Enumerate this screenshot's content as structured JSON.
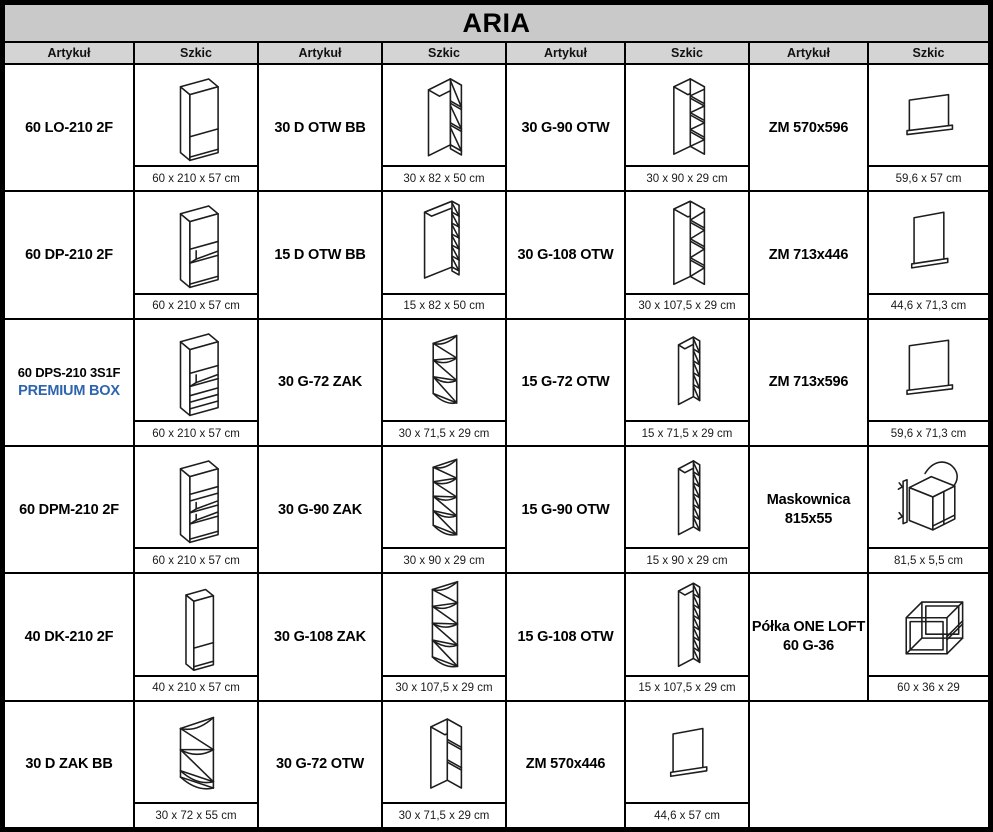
{
  "title": "ARIA",
  "colors": {
    "title_bg": "#c9c9c9",
    "header_bg": "#d4d4d4",
    "border": "#000000",
    "premium_blue": "#2e64ae"
  },
  "column_headers": {
    "article": "Artykuł",
    "sketch": "Szkic"
  },
  "rows": [
    {
      "cells": [
        {
          "article": "60 LO-210 2F",
          "sketch": "tall-2f",
          "dims": "60 x 210 x 57 cm"
        },
        {
          "article": "30 D OTW BB",
          "sketch": "base-open",
          "dims": "30 x 82 x 50 cm"
        },
        {
          "article": "30 G-90 OTW",
          "sketch": "wall-open-4",
          "dims": "30 x 90 x 29 cm"
        },
        {
          "article": "ZM 570x596",
          "sketch": "panel-landscape",
          "dims": "59,6 x 57 cm"
        }
      ]
    },
    {
      "cells": [
        {
          "article": "60 DP-210 2F",
          "sketch": "tall-oven",
          "dims": "60 x 210 x 57 cm"
        },
        {
          "article": "15 D OTW BB",
          "sketch": "base-open-slim",
          "dims": "15 x 82 x 50 cm"
        },
        {
          "article": "30 G-108 OTW",
          "sketch": "wall-open-4-tall",
          "dims": "30 x 107,5 x 29 cm"
        },
        {
          "article": "ZM 713x446",
          "sketch": "panel-portrait",
          "dims": "44,6 x 71,3 cm"
        }
      ]
    },
    {
      "cells": [
        {
          "article": "60 DPS-210 3S1F",
          "article_size": "small",
          "article_line2": "PREMIUM BOX",
          "article_line2_accent": true,
          "sketch": "tall-oven-drawers",
          "dims": "60 x 210 x 57 cm"
        },
        {
          "article": "30 G-72 ZAK",
          "sketch": "corner-zak-3",
          "dims": "30 x 71,5 x 29 cm"
        },
        {
          "article": "15 G-72 OTW",
          "sketch": "wall-narrow-5",
          "dims": "15 x 71,5 x 29 cm"
        },
        {
          "article": "ZM 713x596",
          "sketch": "panel-square",
          "dims": "59,6 x 71,3 cm"
        }
      ]
    },
    {
      "cells": [
        {
          "article": "60 DPM-210 2F",
          "sketch": "tall-micro",
          "dims": "60 x 210 x 57 cm"
        },
        {
          "article": "30 G-90 ZAK",
          "sketch": "corner-zak-4",
          "dims": "30 x 90 x 29 cm"
        },
        {
          "article": "15 G-90 OTW",
          "sketch": "wall-narrow-6",
          "dims": "15 x 90 x 29 cm"
        },
        {
          "article": "Maskownica",
          "article_line2": "815x55",
          "sketch": "maskownica",
          "dims": "81,5 x 5,5 cm"
        }
      ]
    },
    {
      "cells": [
        {
          "article": "40 DK-210 2F",
          "sketch": "tall-2f-narrow",
          "dims": "40 x 210 x 57 cm"
        },
        {
          "article": "30 G-108 ZAK",
          "sketch": "corner-zak-4-tall",
          "dims": "30 x 107,5 x 29 cm"
        },
        {
          "article": "15 G-108 OTW",
          "sketch": "wall-narrow-7",
          "dims": "15 x 107,5 x 29 cm"
        },
        {
          "article": "Półka ONE LOFT",
          "article_line2": "60 G-36",
          "sketch": "loft-shelf",
          "dims": "60 x 36 x 29"
        }
      ]
    },
    {
      "cells": [
        {
          "article": "30 D ZAK BB",
          "sketch": "corner-base-2",
          "dims": "30 x 72 x 55 cm"
        },
        {
          "article": "30 G-72 OTW",
          "sketch": "wall-open-3",
          "dims": "30 x 71,5 x 29 cm"
        },
        {
          "article": "ZM 570x446",
          "sketch": "panel-portrait-small",
          "dims": "44,6 x 57 cm"
        },
        null
      ]
    }
  ]
}
